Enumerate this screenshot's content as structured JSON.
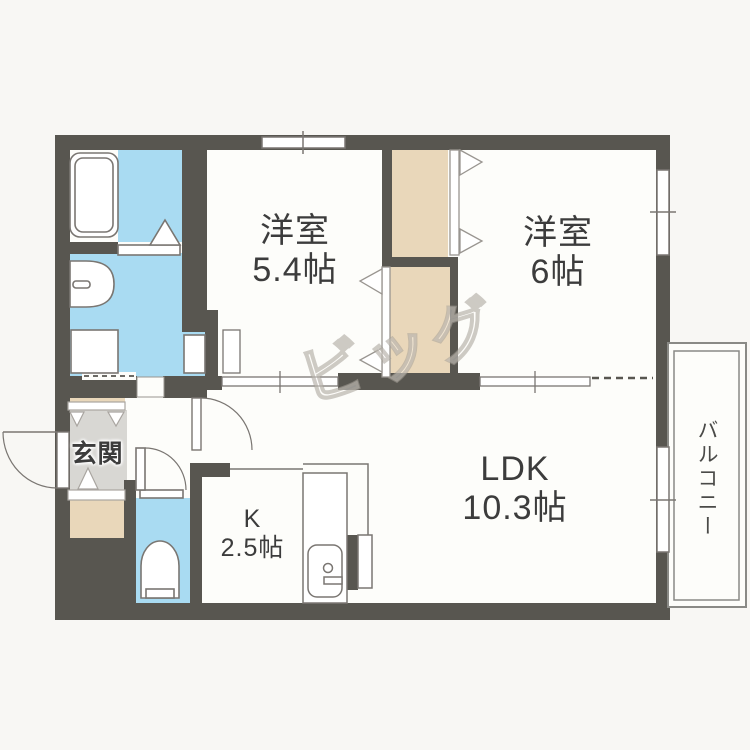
{
  "watermark": "ビッグ",
  "rooms": {
    "western_1": {
      "name": "洋室",
      "size": "5.4帖"
    },
    "western_2": {
      "name": "洋室",
      "size": "6帖"
    },
    "ldk": {
      "name": "LDK",
      "size": "10.3帖"
    },
    "kitchen": {
      "name": "K",
      "size": "2.5帖"
    },
    "entrance": {
      "name": "玄関"
    },
    "balcony": {
      "name": "バルコニー"
    }
  },
  "fixtures": [
    "bathtub",
    "bathroom-door-triangle",
    "washbasin",
    "washing-machine-pan",
    "toilet",
    "kitchen-sink-counter",
    "entrance-step-triangles",
    "closet-folding-doors",
    "sliding-door-tracks",
    "hinged-doors",
    "windows",
    "balcony-rail"
  ],
  "colors": {
    "wall": "#585650",
    "water": "#a9dbf2",
    "closet": "#e9d7ba",
    "entrance_floor": "#d8d7d3",
    "label": "#3c3c3c"
  }
}
